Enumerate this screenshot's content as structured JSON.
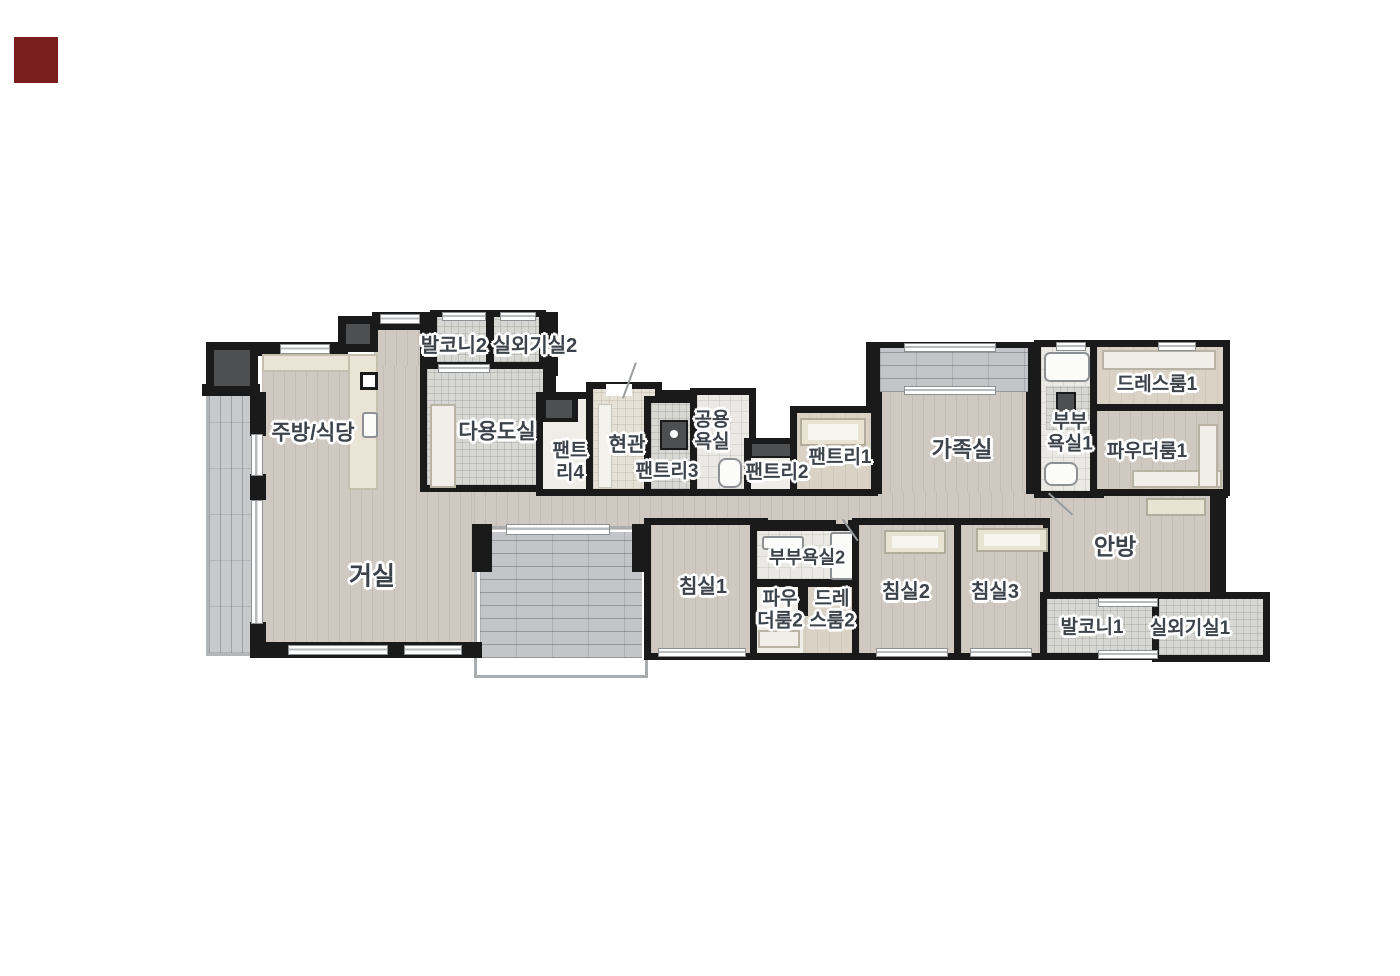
{
  "marker": {
    "color": "#7a1d1d"
  },
  "colors": {
    "wall": "#1a1a1a",
    "label_text": "#3d434b",
    "wood_floor": "#cfc9c1",
    "tile_gray": "#d7d7d4",
    "balcony_brick": "#c7c9ca",
    "terrace_brick": "#c3c5c8",
    "bath_tile": "#eae9e5"
  },
  "labels": {
    "balcony2_row": "발코니2 실외기실2",
    "kitchen_dining": "주방/식당",
    "utility_room": "다용도실",
    "pantry4_line1": "팬트",
    "pantry4_line2": "리4",
    "entrance": "현관",
    "pantry3": "팬트리3",
    "common_bath_line1": "공용",
    "common_bath_line2": "욕실",
    "pantry2": "팬트리2",
    "pantry1": "팬트리1",
    "family_room": "가족실",
    "master_bath1_line1": "부부",
    "master_bath1_line2": "욕실1",
    "dress_room1": "드레스룸1",
    "powder_room1": "파우더룸1",
    "living_room": "거실",
    "bedroom1": "침실1",
    "master_bath2": "부부욕실2",
    "powder_room2_line1": "파우",
    "powder_room2_line2": "더룸2",
    "dress_room2_line1": "드레",
    "dress_room2_line2": "스룸2",
    "bedroom2": "침실2",
    "bedroom3": "침실3",
    "master_bedroom": "안방",
    "balcony1": "발코니1",
    "outdoor_unit1": "실외기실1"
  }
}
